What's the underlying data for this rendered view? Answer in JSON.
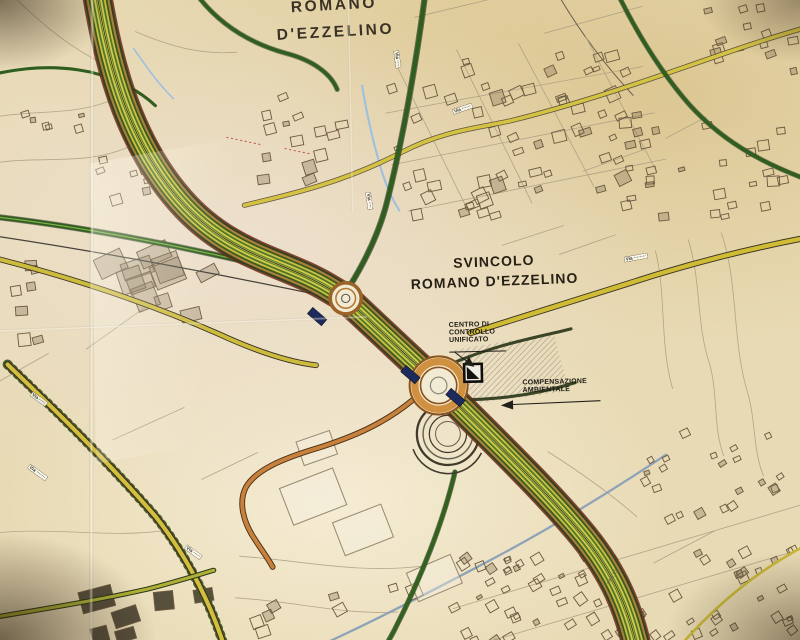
{
  "map_title": {
    "town_line1": "ROMANO",
    "town_line2": "D'EZZELINO",
    "interchange_line1": "SVINCOLO",
    "interchange_line2": "ROMANO D'EZZELINO"
  },
  "callouts": {
    "control_center": {
      "lines": [
        "CENTRO DI",
        "CONTROLLO",
        "UNIFICATO"
      ]
    },
    "environmental": {
      "lines": [
        "COMPENSAZIONE",
        "AMBIENTALE"
      ]
    }
  },
  "road_labels": [
    {
      "text": "Via ········"
    },
    {
      "text": "Via ·····"
    },
    {
      "text": "Via ·······"
    },
    {
      "text": "Via ·····"
    },
    {
      "text": "Via ······"
    },
    {
      "text": "Via ····"
    },
    {
      "text": "Via ····"
    }
  ],
  "elevation_marks": [
    {
      "text": "+43.33"
    }
  ],
  "colors": {
    "paper": "#e8dab4",
    "highway_stripe_yellow": "#d2cc4a",
    "highway_stripe_green": "#3f5a1e",
    "highway_edge_brown": "#a8813c",
    "highway_casing_red": "#6e2a18",
    "roundabout_ring": "#cf9040",
    "local_road_green": "#2f5e20",
    "local_road_yellow": "#d0bc34",
    "ramp_orange": "#c8813c",
    "stream_blue": "#8fa3b8",
    "overpass_navy": "#1c2a5e"
  }
}
